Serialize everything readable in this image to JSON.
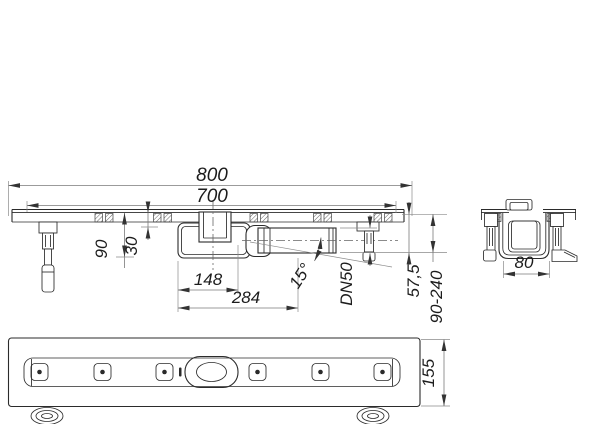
{
  "drawing": {
    "side_view": {
      "dims": {
        "overall_length": "800",
        "grate_length": "700",
        "body_height": "90",
        "channel_depth": "30",
        "trap_width": "148",
        "outlet_projection": "284",
        "outlet_angle": "15°",
        "outlet_diameter": "DN50",
        "outlet_depth": "57,5",
        "installation_height": "90-240"
      }
    },
    "end_view": {
      "dims": {
        "channel_width": "80"
      }
    },
    "plan_view": {
      "dims": {
        "flange_width": "155"
      }
    }
  }
}
